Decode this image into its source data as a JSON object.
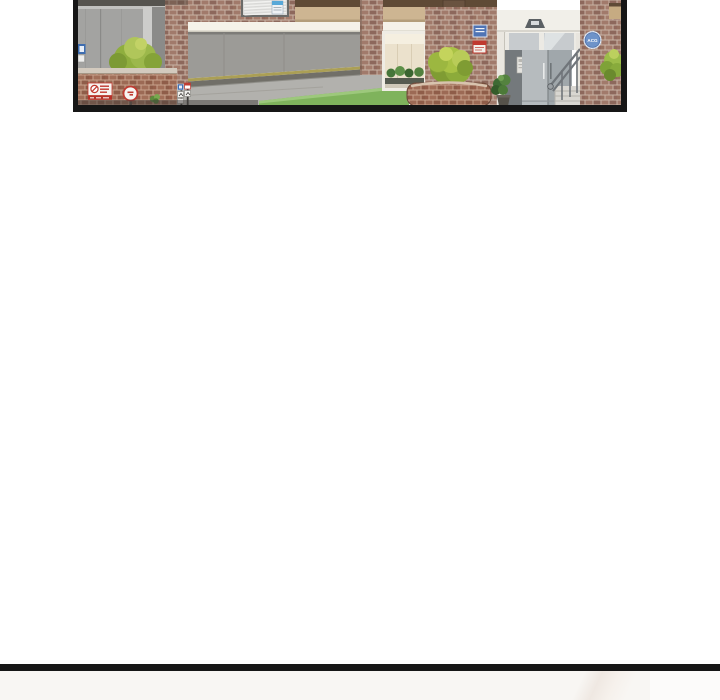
{
  "page": {
    "kind": "webtoon-reader-page",
    "background_color": "#ffffff"
  },
  "comic_panel": {
    "scene": "apartment building entrance with garage ramp, brick pillars, hedges, glass lobby doors and stair railing",
    "border_color": "#161616",
    "badge_label": "ACG",
    "colors": {
      "brick_wall": "#a17a6b",
      "brick_mortar": "#c8b2a4",
      "planter_brick": "#9c6a55",
      "shutter_gray": "#9c9b97",
      "driveway_gray": "#b2b1ad",
      "hedge_green": "#a9c245",
      "grass_green": "#7fb35c",
      "fascia_tan": "#cdb592",
      "beam_brown": "#5f4a36",
      "beam_white": "#f5f2e9",
      "badge_blue": "#6e93c9",
      "sign_red": "#c0392f",
      "sign_blue": "#4f74b4"
    }
  },
  "next_panel": {
    "divider_color": "#161616",
    "background_color": "#f8f6f3"
  }
}
